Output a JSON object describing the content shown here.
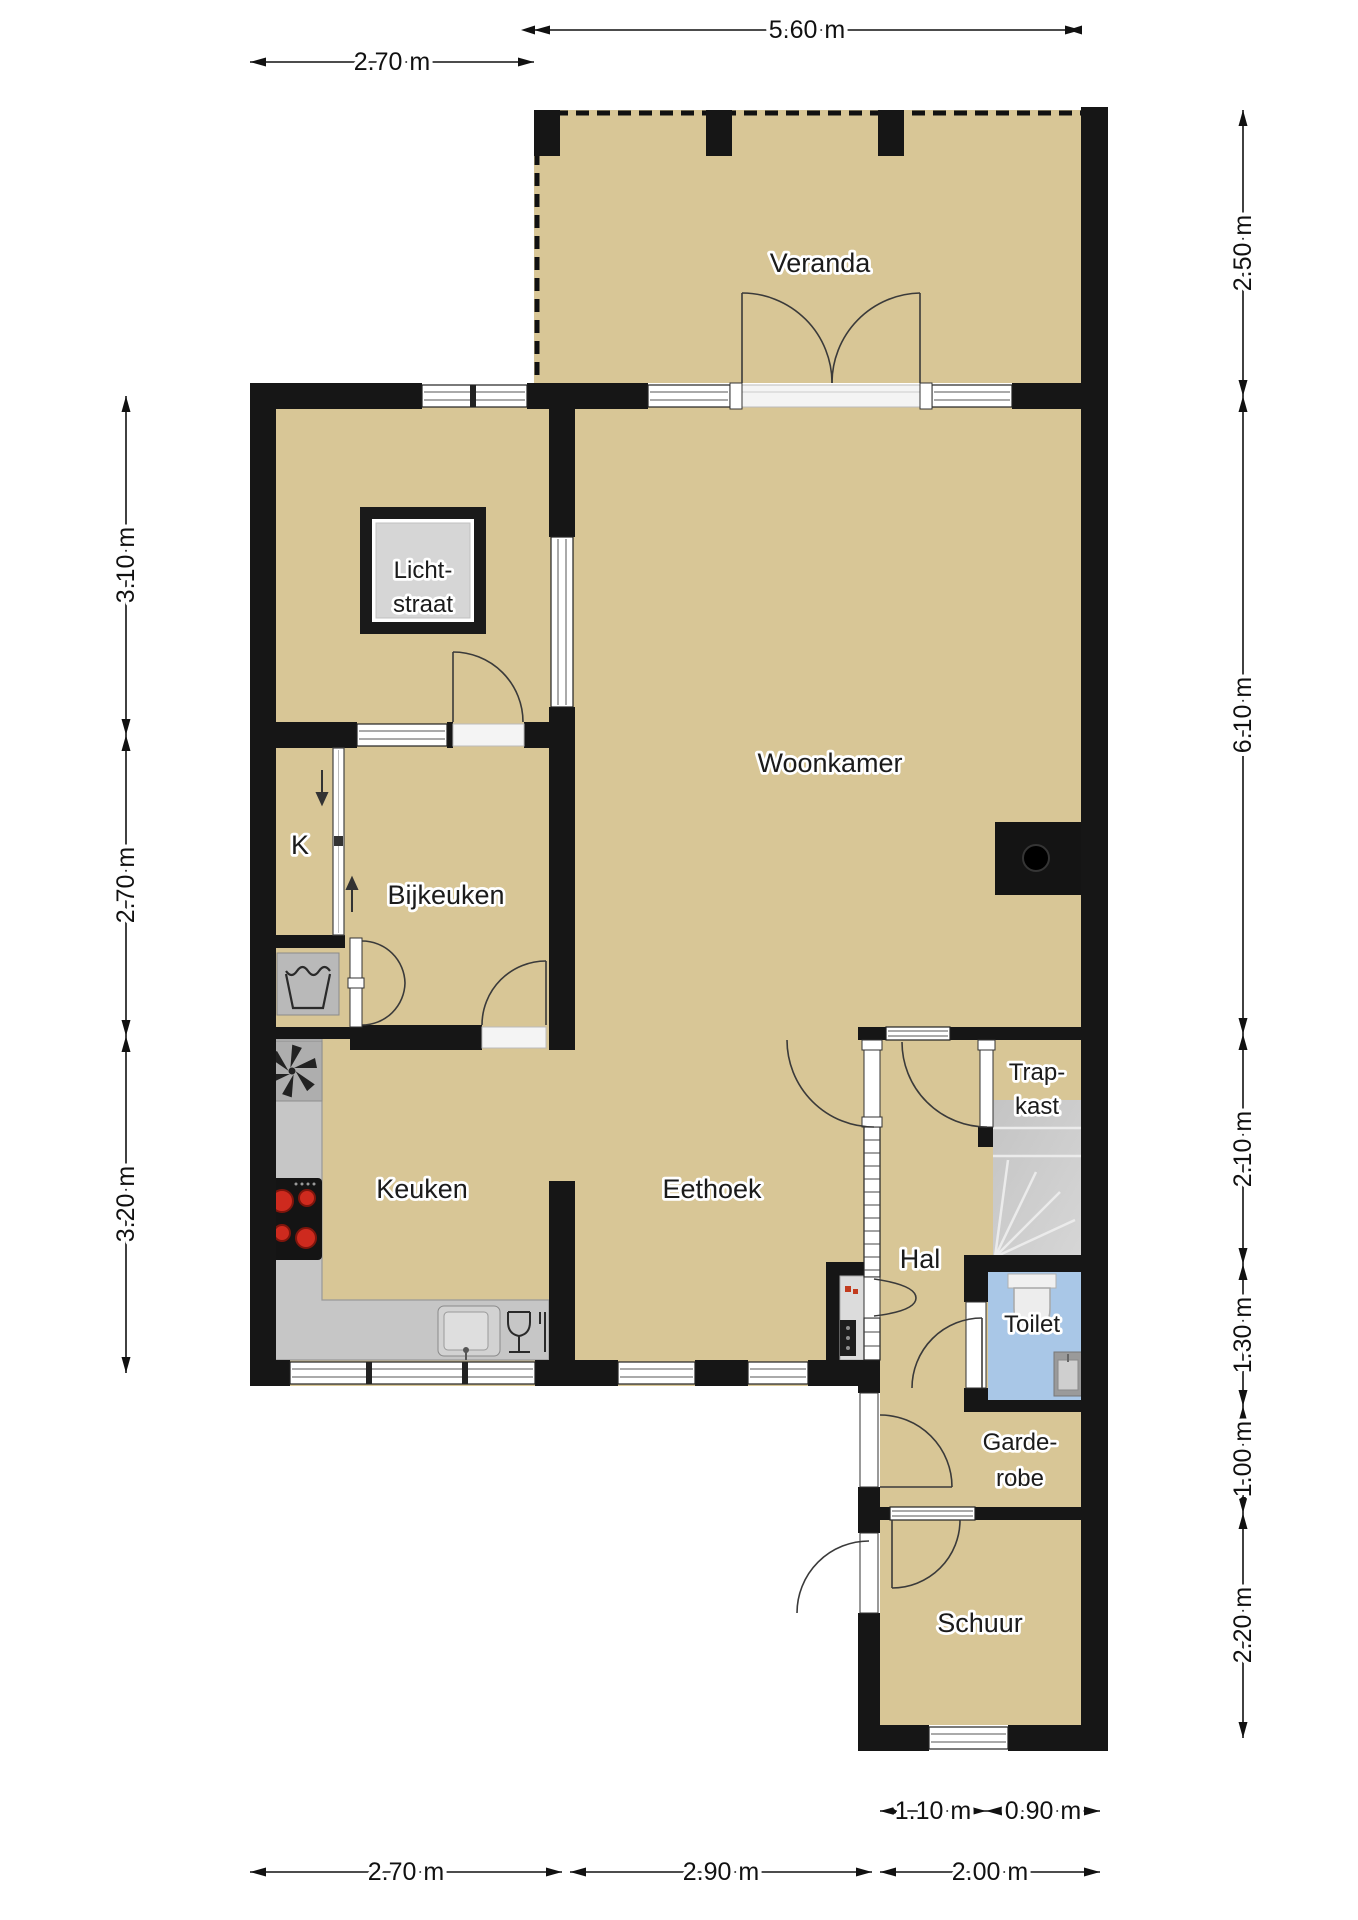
{
  "plan": {
    "type": "floor-plan",
    "language": "nl"
  },
  "colors": {
    "background": "#ffffff",
    "floor": "#d8c696",
    "wall": "#161616",
    "toilet_floor": "#a9c7e7",
    "counter": "#c6c6c6",
    "stairs": "#c9c9c9",
    "appliance_gray": "#aeaeae",
    "stove_black": "#141414",
    "burner_red": "#ce2a1e",
    "glass_white": "#ffffff"
  },
  "rooms": {
    "veranda": {
      "lines": [
        "Veranda"
      ]
    },
    "lichtstraat": {
      "lines": [
        "Licht-",
        "straat"
      ]
    },
    "woonkamer": {
      "lines": [
        "Woonkamer"
      ]
    },
    "kast": {
      "lines": [
        "K"
      ]
    },
    "bijkeuken": {
      "lines": [
        "Bijkeuken"
      ]
    },
    "keuken": {
      "lines": [
        "Keuken"
      ]
    },
    "eethoek": {
      "lines": [
        "Eethoek"
      ]
    },
    "hal": {
      "lines": [
        "Hal"
      ]
    },
    "trapkast": {
      "lines": [
        "Trap-",
        "kast"
      ]
    },
    "toilet": {
      "lines": [
        "Toilet"
      ]
    },
    "garderobe": {
      "lines": [
        "Garde-",
        "robe"
      ]
    },
    "schuur": {
      "lines": [
        "Schuur"
      ]
    }
  },
  "dimensions": {
    "top_main": "5.60 m",
    "top_left": "2.70 m",
    "left": [
      "3.10 m",
      "2.70 m",
      "3.20 m"
    ],
    "right": [
      "2.50 m",
      "6.10 m",
      "2.10 m",
      "1.30 m",
      "1.00 m",
      "2.20 m"
    ],
    "bottom": [
      "2.70 m",
      "2.90 m",
      "2.00 m"
    ],
    "schuur_split": [
      "1.10 m",
      "0.90 m"
    ]
  },
  "icons": {
    "washing_machine": "washing-machine-icon",
    "extractor_fan": "extractor-fan-icon",
    "stove": "stove-icon",
    "sink": "sink-icon",
    "dishwasher": "dishwasher-icon",
    "fireplace": "fireplace-icon",
    "stairs": "stairs-icon",
    "toilet_bowl": "toilet-icon",
    "hand_basin": "hand-basin-icon",
    "heater": "heater-icon",
    "skylight": "skylight-icon"
  }
}
